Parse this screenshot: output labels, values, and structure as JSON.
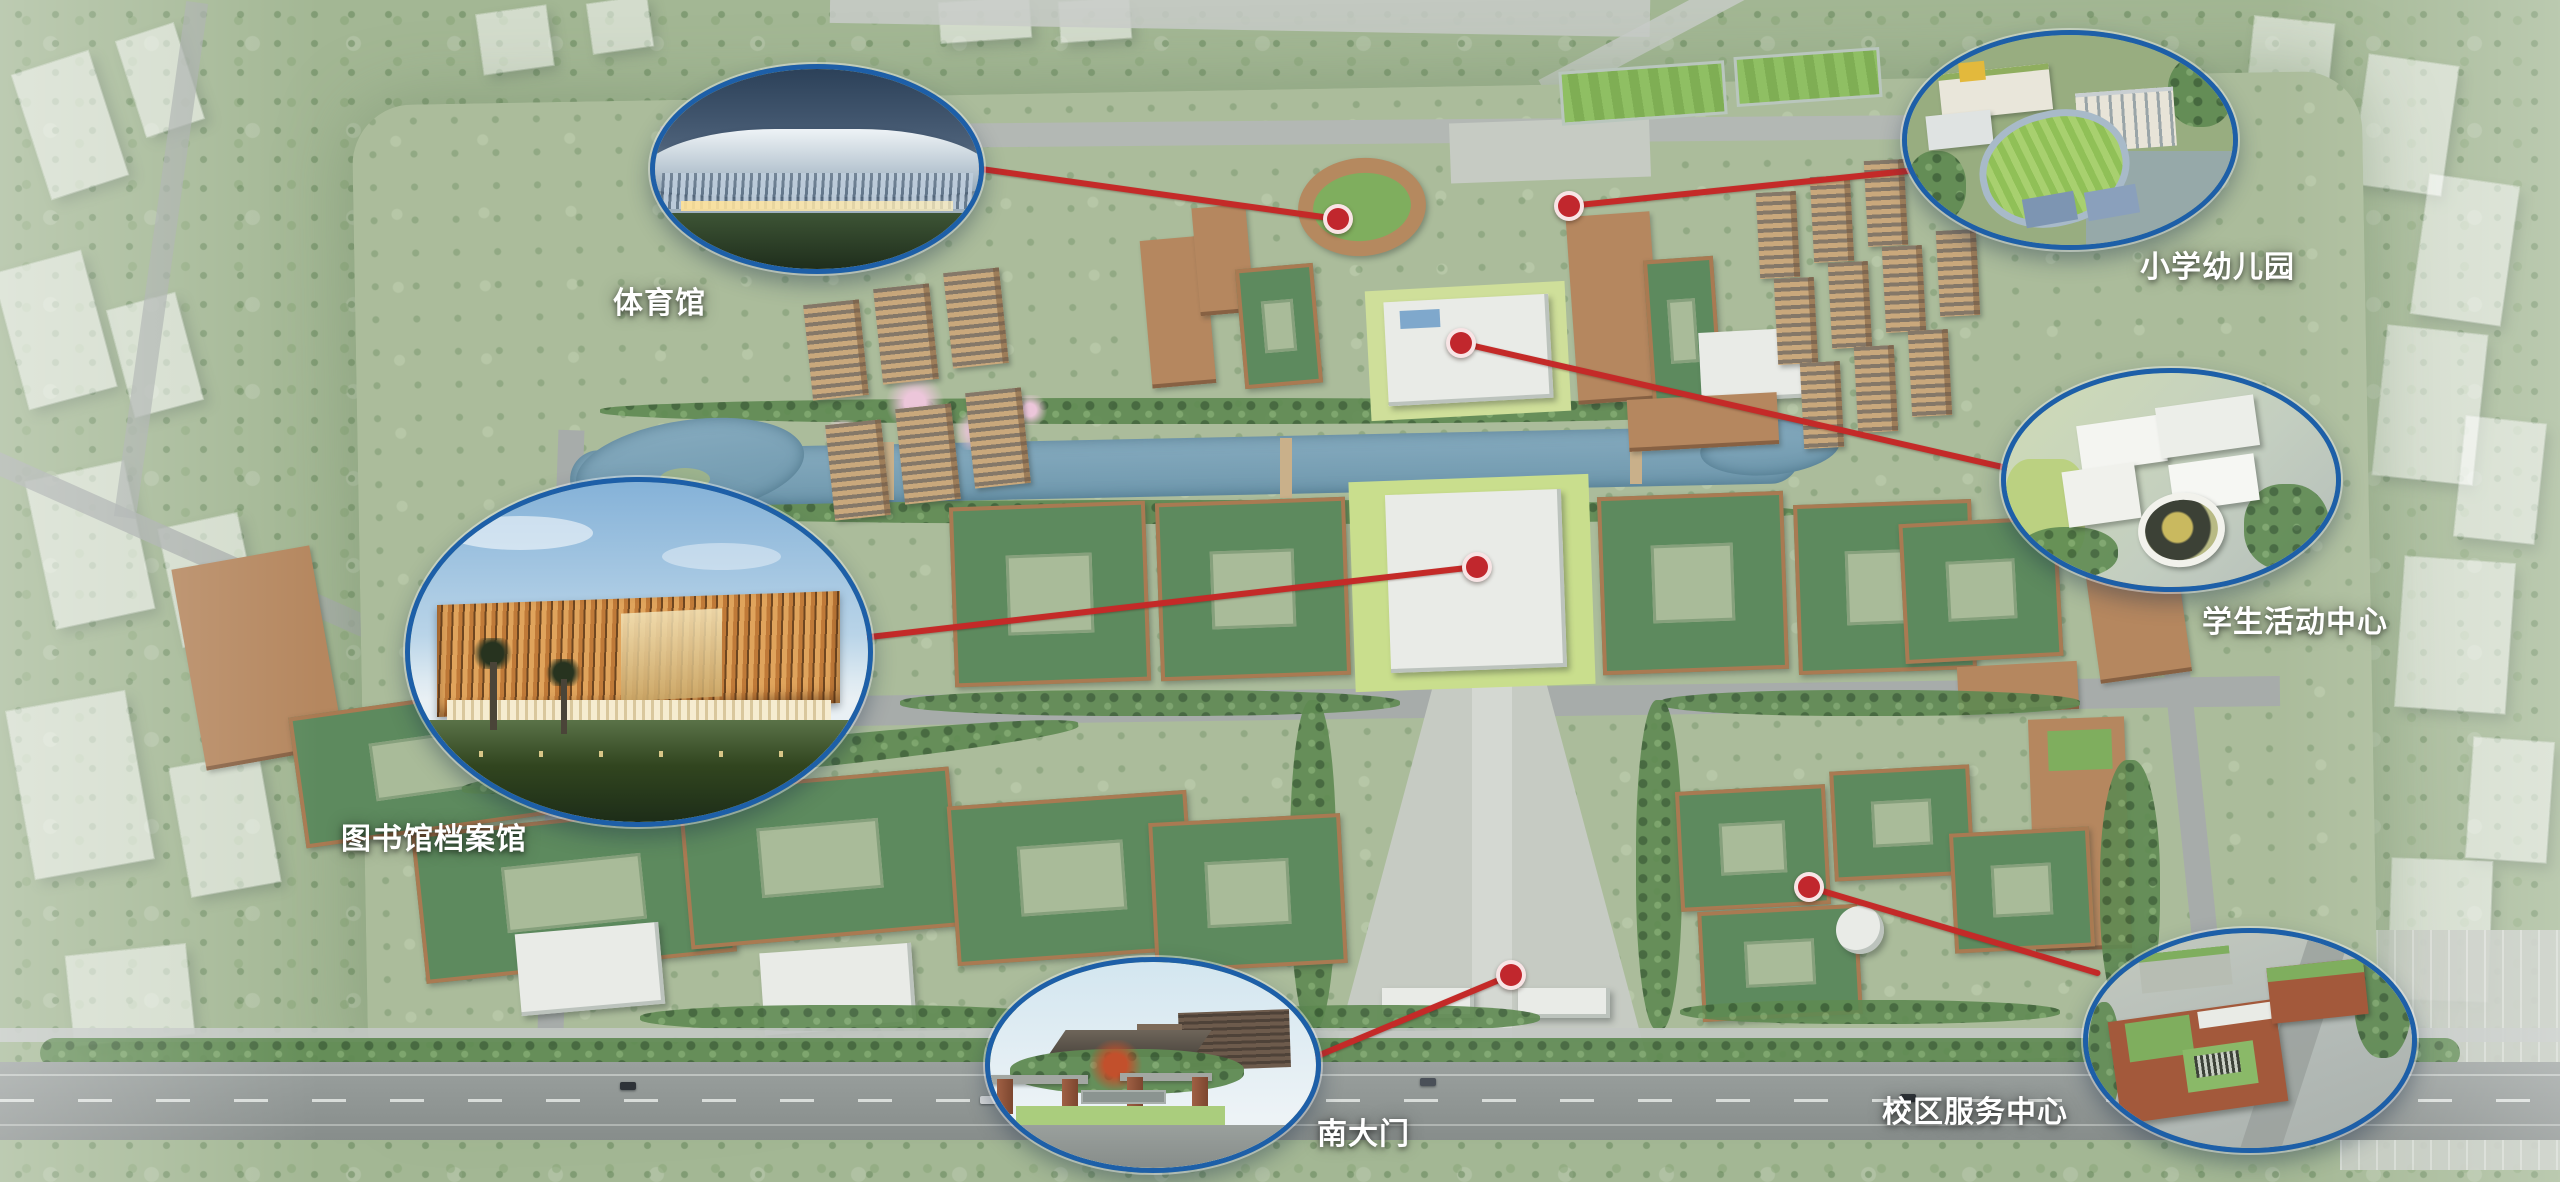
{
  "annotations": [
    {
      "id": "gymnasium",
      "label": "体育馆"
    },
    {
      "id": "primary-school-kindergarten",
      "label": "小学幼儿园"
    },
    {
      "id": "student-activity-center",
      "label": "学生活动中心"
    },
    {
      "id": "library-archives",
      "label": "图书馆档案馆"
    },
    {
      "id": "south-gate",
      "label": "南大门"
    },
    {
      "id": "campus-service-center",
      "label": "校区服务中心"
    }
  ],
  "colors": {
    "callout_border": "#1d5fa8",
    "connector_line": "#c42a28",
    "marker_dot": "#c1272d",
    "label_text": "#ffffff"
  }
}
